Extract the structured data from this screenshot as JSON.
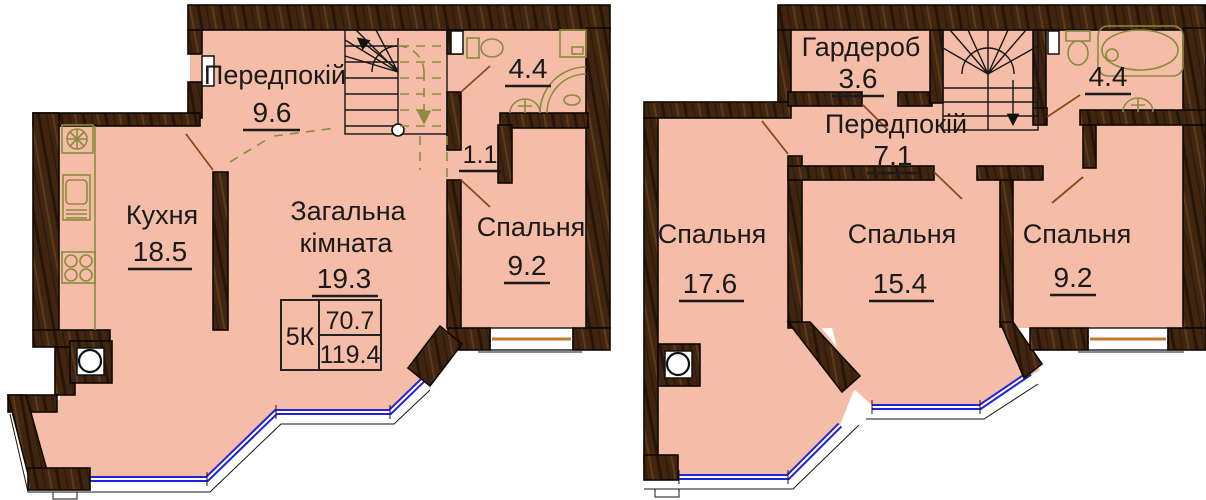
{
  "colors": {
    "floor": "#f5bda7",
    "wall": "#402511",
    "fixture_outline": "#8b8b3e",
    "window_glass": "#2222d8",
    "window_sill": "#c07a2c",
    "door_leaf": "#8a4a1c",
    "text": "#1a1a1a"
  },
  "left": {
    "hallway": {
      "name": "Передпокій",
      "area": "9.6"
    },
    "kitchen": {
      "name": "Кухня",
      "area": "18.5"
    },
    "living": {
      "name1": "Загальна",
      "name2": "кімната",
      "area": "19.3"
    },
    "bedroom": {
      "name": "Спальня",
      "area": "9.2"
    },
    "bathroom": {
      "area": "4.4"
    },
    "duct": {
      "area": "1.1"
    },
    "info": {
      "label": "5К",
      "upper": "70.7",
      "total": "119.4"
    }
  },
  "right": {
    "wardrobe": {
      "name": "Гардероб",
      "area": "3.6"
    },
    "hallway": {
      "name": "Передпокій",
      "area": "7.1"
    },
    "bathroom": {
      "area": "4.4"
    },
    "bedroom1": {
      "name": "Спальня",
      "area": "17.6"
    },
    "bedroom2": {
      "name": "Спальня",
      "area": "15.4"
    },
    "bedroom3": {
      "name": "Спальня",
      "area": "9.2"
    }
  }
}
